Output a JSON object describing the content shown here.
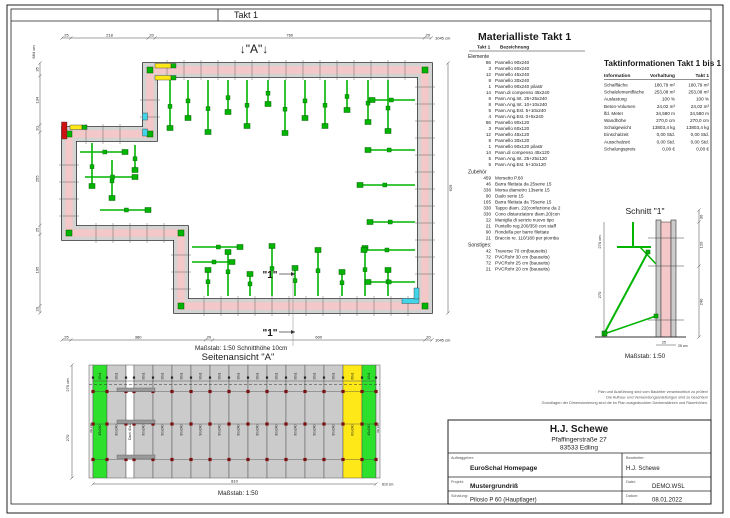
{
  "colors": {
    "wall_concrete": "#f4c8c8",
    "panel_gray": "#d3d3d3",
    "brace_green": "#00b400",
    "panel_green": "#2ce02c",
    "accent_yellow": "#ffe818",
    "accent_red": "#cc1111",
    "accent_cyan": "#42d4e8",
    "tie_dot": "#7a1010"
  },
  "page": {
    "header_title": "Takt 1"
  },
  "plan": {
    "view_a_marker": "↓\"A\"↓",
    "section_marker": "\"1\"",
    "scale_note": "Maßstab: 1:50   Schnitthöhe 10cm",
    "dims": {
      "top": [
        "25",
        "218",
        "20",
        "760",
        "20"
      ],
      "top_total": "1045 cm",
      "left": [
        "35",
        "134",
        "20",
        "255",
        "25",
        "195",
        "20"
      ],
      "left_total": "684 cm",
      "right_total": "629",
      "bottom": [
        "25",
        "380",
        "20",
        "600",
        "20"
      ],
      "bottom_total": "1045 cm"
    }
  },
  "side_view": {
    "title": "Seitenansicht \"A\"",
    "scale": "Maßstab: 1:50",
    "dim_height_total": "270 cm",
    "dim_height": "270",
    "dim_width": "810",
    "dim_width_total": "810 cm",
    "left_edge_label": "AE 240",
    "right_edge_label": "AE 240",
    "panels": [
      {
        "label": "45x240",
        "top_label": "45x1",
        "color": "green",
        "w": 14
      },
      {
        "label": "90x240",
        "top_label": "90x1",
        "color": "gray",
        "w": 19
      },
      {
        "label": "Dach 40x240",
        "top_label": "",
        "color": "white",
        "w": 8
      },
      {
        "label": "90x240",
        "top_label": "90x1",
        "color": "gray",
        "w": 19
      },
      {
        "label": "90x240",
        "top_label": "90x1",
        "color": "gray",
        "w": 19
      },
      {
        "label": "90x240",
        "top_label": "90x1",
        "color": "gray",
        "w": 19
      },
      {
        "label": "90x240",
        "top_label": "90x1",
        "color": "gray",
        "w": 19
      },
      {
        "label": "90x240",
        "top_label": "90x1",
        "color": "gray",
        "w": 19
      },
      {
        "label": "90x240",
        "top_label": "90x1",
        "color": "gray",
        "w": 19
      },
      {
        "label": "90x240",
        "top_label": "90x1",
        "color": "gray",
        "w": 19
      },
      {
        "label": "90x240",
        "top_label": "90x1",
        "color": "gray",
        "w": 19
      },
      {
        "label": "90x240",
        "top_label": "90x1",
        "color": "gray",
        "w": 19
      },
      {
        "label": "90x240",
        "top_label": "90x1",
        "color": "gray",
        "w": 19
      },
      {
        "label": "90x240",
        "top_label": "90x1",
        "color": "gray",
        "w": 19
      },
      {
        "label": "60x240",
        "top_label": "60x1",
        "color": "yellow",
        "w": 19
      },
      {
        "label": "45x240",
        "top_label": "45x1",
        "color": "green",
        "w": 14
      }
    ]
  },
  "schnitt": {
    "title": "Schnitt \"1\"",
    "scale": "Maßstab: 1:50",
    "dim_left_total": "270 cm",
    "dim_left": "270",
    "dim_right_top": "30",
    "dim_right_mid": "120",
    "dim_right_bot": "240",
    "dim_bottom": "25",
    "dim_bottom_total": "25 cm"
  },
  "material_list": {
    "title": "Materialliste  Takt 1",
    "col_takt": "Takt 1",
    "col_name": "Bezeichnung",
    "sections": [
      {
        "name": "Elemente",
        "items": [
          {
            "qty": "86",
            "name": "Pannello 90x240"
          },
          {
            "qty": "3",
            "name": "Pannello 60x240"
          },
          {
            "qty": "12",
            "name": "Pannello 45x240"
          },
          {
            "qty": "8",
            "name": "Pannello 30x240"
          },
          {
            "qty": "1",
            "name": "Pannello 90x240 pilastr"
          },
          {
            "qty": "14",
            "name": "Pann.di compenso 45x240"
          },
          {
            "qty": "6",
            "name": "Pann.Ang.Int. 25+25x240"
          },
          {
            "qty": "8",
            "name": "Pann.Ang.Int. 10+10x240"
          },
          {
            "qty": "5",
            "name": "Pann.Ang.Est. 5+10x240"
          },
          {
            "qty": "4",
            "name": "Pann.Ang.Est. 0+5x240"
          },
          {
            "qty": "86",
            "name": "Pannello 90x120"
          },
          {
            "qty": "3",
            "name": "Pannello 60x120"
          },
          {
            "qty": "12",
            "name": "Pannello 45x120"
          },
          {
            "qty": "8",
            "name": "Pannello 30x120"
          },
          {
            "qty": "1",
            "name": "Pannello 90x120 pilastr"
          },
          {
            "qty": "14",
            "name": "Pann.di compenso 45x120"
          },
          {
            "qty": "5",
            "name": "Pann.Ang.Int. 25+25x120"
          },
          {
            "qty": "5",
            "name": "Pann.Ang.Est. 5+10x120"
          }
        ]
      },
      {
        "name": "Zubehör",
        "items": [
          {
            "qty": "459",
            "name": "Morsetto P.60"
          },
          {
            "qty": "46",
            "name": "Barra filettata da 25serie 15"
          },
          {
            "qty": "336",
            "name": "Morsa diametro 13serie 15"
          },
          {
            "qty": "90",
            "name": "Dado serie 15"
          },
          {
            "qty": "165",
            "name": "Barra filettata da 75serie 15"
          },
          {
            "qty": "330",
            "name": "Tappo diam. 22(confezione da 2"
          },
          {
            "qty": "330",
            "name": "Cono distanziatore diam.20(con"
          },
          {
            "qty": "22",
            "name": "Maniglia di serizio nuovo tipo"
          },
          {
            "qty": "21",
            "name": "Puntello reg.200/350 con staff"
          },
          {
            "qty": "90",
            "name": "Rondella per barre filettate"
          },
          {
            "qty": "21",
            "name": "Braccio re. 110/180 per piomba"
          }
        ]
      },
      {
        "name": "Sonstiges:",
        "items": [
          {
            "qty": "42",
            "name": "Traverse 70 cm(bauseits)"
          },
          {
            "qty": "72",
            "name": "PVCRohr 30 cm (bauseits)"
          },
          {
            "qty": "72",
            "name": "PVCRohr 25 cm (bauseits)"
          },
          {
            "qty": "21",
            "name": "PVCRohr 20 cm (bauseits)"
          }
        ]
      }
    ]
  },
  "takt_info": {
    "title": "Taktinformationen  Takt 1 bis 1",
    "headers": [
      "Information",
      "Vorhaltung",
      "Takt 1"
    ],
    "rows": [
      {
        "label": "Schalfläche",
        "vorhaltung": "180,79 m²",
        "takt1": "180,79 m²"
      },
      {
        "label": "Schalelementfläche",
        "vorhaltung": "253,08 m²",
        "takt1": "253,08 m²"
      },
      {
        "label": "Auslastung",
        "vorhaltung": "100 %",
        "takt1": "100 %"
      },
      {
        "label": "Beton-Volumen",
        "vorhaltung": "24,02 m³",
        "takt1": "24,02 m³"
      },
      {
        "label": "lfd. Meter",
        "vorhaltung": "34,580 m",
        "takt1": "34,580 m"
      },
      {
        "label": "Wandhöhe",
        "vorhaltung": "270,0 cm",
        "takt1": "270,0 cm"
      },
      {
        "label": "Schalgewicht",
        "vorhaltung": "13803,4 kg",
        "takt1": "13803,4 kg"
      },
      {
        "label": "Einschalzeit",
        "vorhaltung": "0,00 Std.",
        "takt1": "0,00 Std."
      },
      {
        "label": "Ausschalzeit",
        "vorhaltung": "0,00 Std.",
        "takt1": "0,00 Std."
      },
      {
        "label": "Schalungspreis",
        "vorhaltung": "0,00 €",
        "takt1": "0,00 €"
      }
    ]
  },
  "disclaimer": {
    "lines": [
      "Plan und Ausführung sind vom Bauleiter verantwortlich zu prüfen!",
      "Die Aufbau- und Verwendungsanleitungen sind zu beachten!",
      "Grundlagen der Dimensionierung sind die im Plan ausgedruckten Deckenstärken und Raumhöhen."
    ]
  },
  "title_block": {
    "company": "H.J. Schewe",
    "street": "Pfaffingerstraße 27",
    "city": "83533 Edling",
    "auftraggeber_label": "Auftraggeber:",
    "auftraggeber": "EuroSchal Homepage",
    "bearbeiter_label": "Bearbeiter:",
    "bearbeiter": "H.J. Schewe",
    "projekt_label": "Projekt:",
    "projekt": "Mustergrundriß",
    "datei_label": "Datei:",
    "datei": "DEMO.WSL",
    "schalung_label": "Schalung:",
    "schalung": "Pilosio P 60 (Hauptlager)",
    "datum_label": "Datum:",
    "datum": "08.01.2022"
  }
}
